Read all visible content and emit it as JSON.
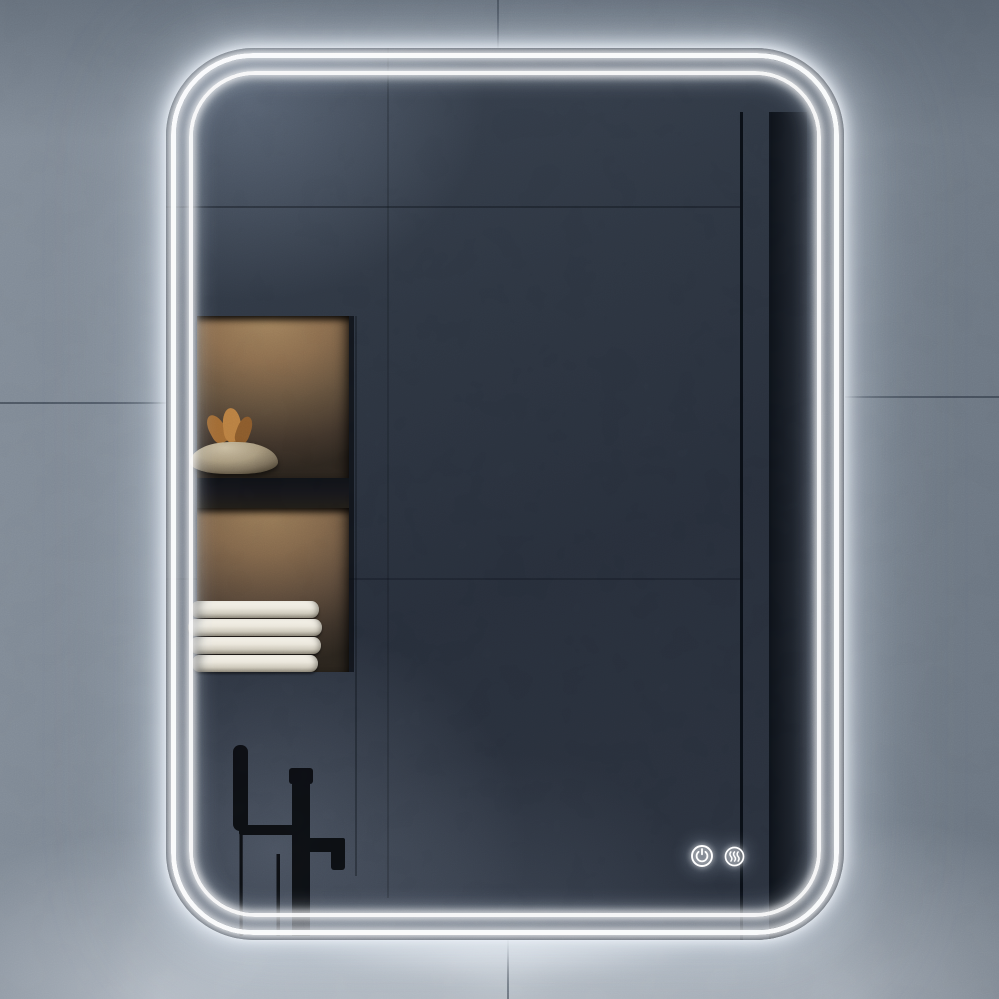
{
  "meta": {
    "type": "product-photo",
    "subject": "Rounded rectangular LED bathroom mirror with double light ring, mounted on a blue-grey stone tiled wall"
  },
  "wall": {
    "base_color": "#768089",
    "seam_color": "#26303c",
    "glow_color": "#eef3f8"
  },
  "mirror": {
    "shape": "rounded-rectangle",
    "glass_color": "#2b3340",
    "led_rings": [
      {
        "name": "outer",
        "color": "#ffffff"
      },
      {
        "name": "inner",
        "color": "#ffffff"
      }
    ]
  },
  "touch_controls": {
    "buttons": [
      {
        "name": "power",
        "icon": "power-icon",
        "color": "#ffffff"
      },
      {
        "name": "defogger",
        "icon": "defogger-icon",
        "color": "#ffffff"
      }
    ]
  },
  "reflection": {
    "niche_upper": {
      "contents": "stone bowl with dried plant",
      "light": "warm",
      "wall_color": "#8a6c4d"
    },
    "niche_lower": {
      "contents": "stack of folded white towels",
      "towel_count": 4,
      "light": "warm",
      "towel_color": "#f2efe6"
    },
    "faucet": {
      "style": "freestanding black tub filler with hand shower",
      "color": "#0a0c10"
    },
    "window": {
      "view": "forest trees with sky glimpses",
      "colors": [
        "#0a131e",
        "#214450",
        "#42633e"
      ]
    }
  }
}
